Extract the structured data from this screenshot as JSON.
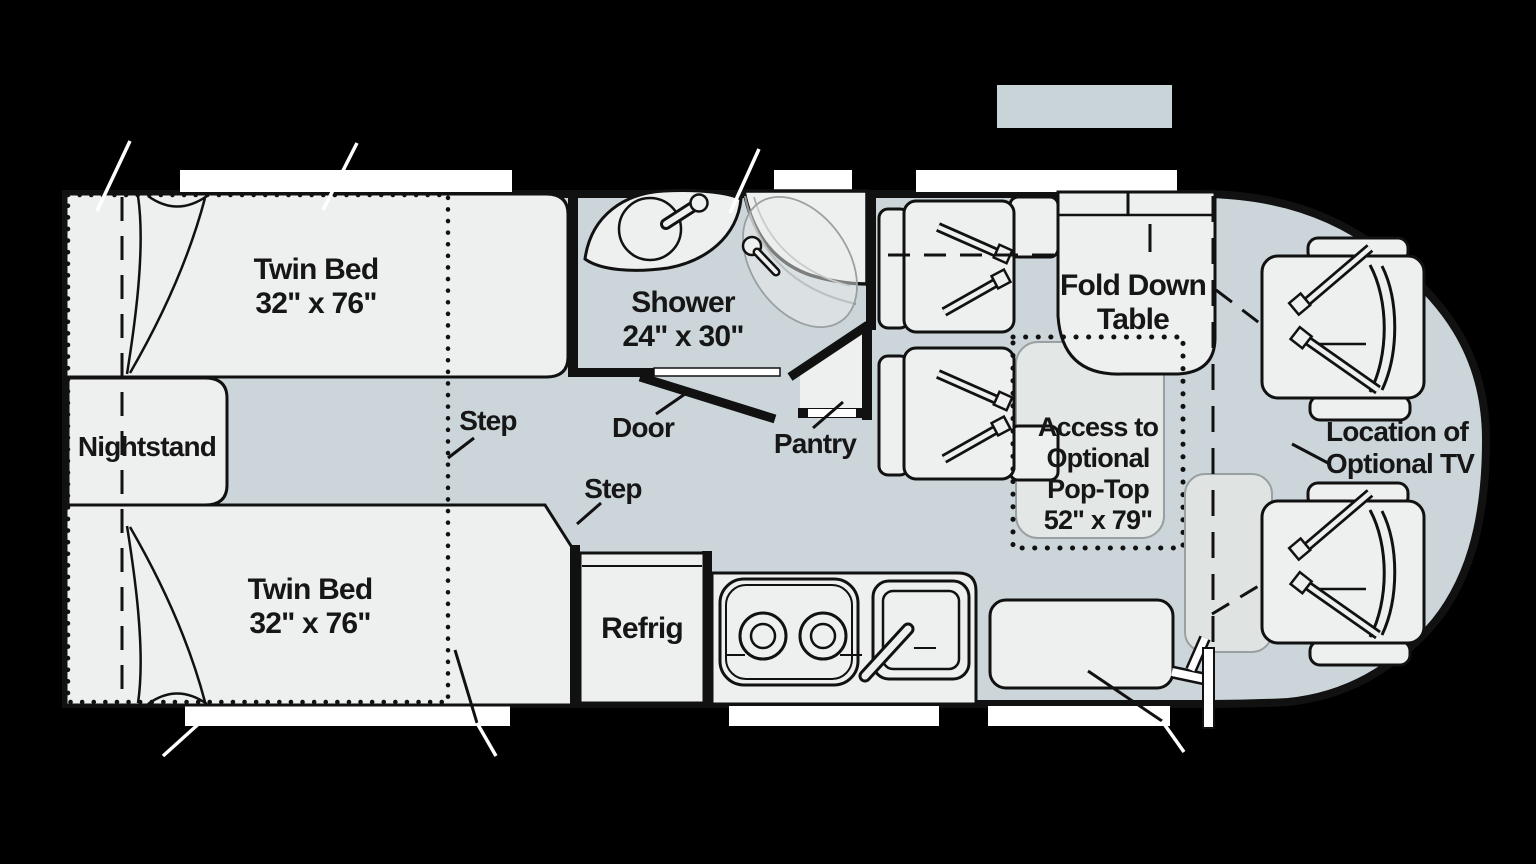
{
  "diagram": {
    "type": "rv-floorplan",
    "colors": {
      "background": "#000000",
      "floor": "#ccd6da",
      "furniture": "#eef0ef",
      "wall": "#111111",
      "soft_gray_zone": "#dfe3e2",
      "pop_top_gray": "#e3e7e5",
      "window_white": "#ffffff"
    },
    "labels": {
      "bed_top": {
        "title": "Twin Bed",
        "dims": "32\" x 76\""
      },
      "bed_bottom": {
        "title": "Twin Bed",
        "dims": "32\" x 76\""
      },
      "nightstand": "Nightstand",
      "step_upper": "Step",
      "step_lower": "Step",
      "door": "Door",
      "pantry": "Pantry",
      "shower": {
        "title": "Shower",
        "dims": "24\" x 30\""
      },
      "refrigerator": "Refrig",
      "fold_down_table": {
        "line1": "Fold Down",
        "line2": "Table"
      },
      "pop_top_access": {
        "line1": "Access to",
        "line2": "Optional",
        "line3": "Pop-Top",
        "line4": "52\" x 79\""
      },
      "optional_tv": {
        "line1": "Location of",
        "line2": "Optional TV"
      }
    },
    "features": [
      "twin-bed-top",
      "twin-bed-bottom",
      "nightstand",
      "privacy-curtain",
      "pop-top-bed-outline",
      "bath-sink",
      "corner-shower",
      "bath-door",
      "pantry-closet",
      "refrigerator",
      "two-burner-cooktop",
      "kitchen-sink",
      "ottoman-table",
      "dinette-seat-front",
      "dinette-seat-rear",
      "fold-down-table",
      "pop-top-access-area",
      "driver-seat",
      "passenger-seat",
      "entry-door",
      "exterior-windows",
      "overhead-bunk"
    ]
  }
}
